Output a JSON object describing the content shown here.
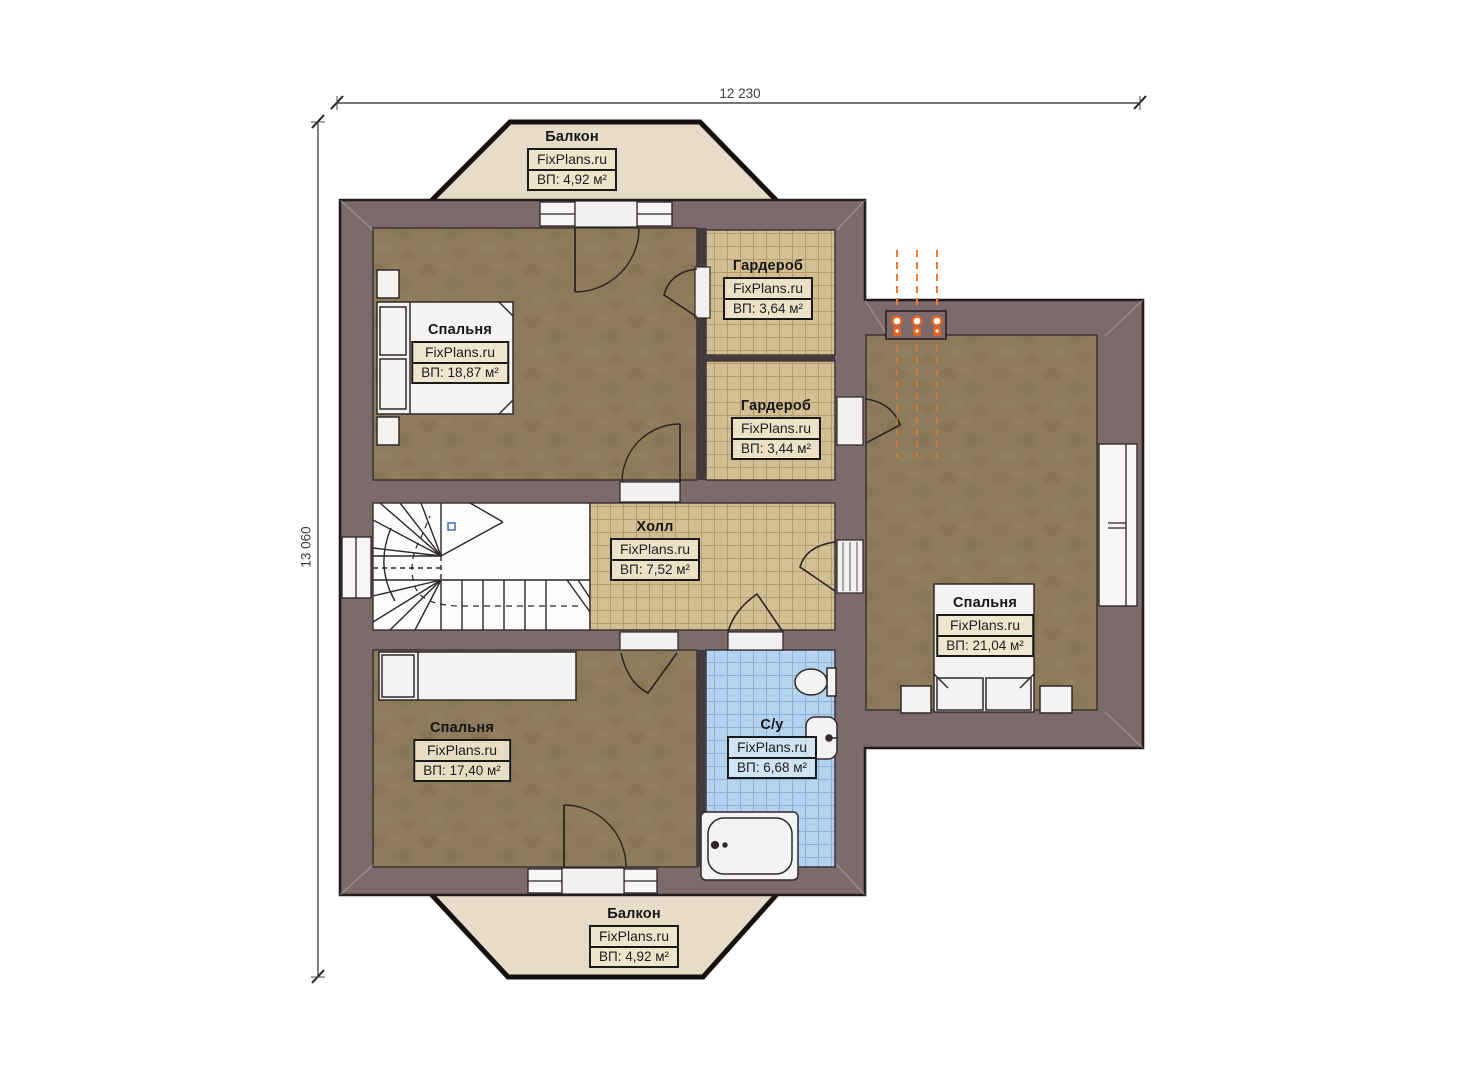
{
  "plan": {
    "type": "floor-plan",
    "floor_note": "second floor plan with stairwell",
    "brand_watermark": "FixPlans.ru"
  },
  "dimensions": {
    "width_label": "12 230",
    "height_label": "13 060"
  },
  "rooms": {
    "balcony_top": {
      "name": "Балкон",
      "brand": "FixPlans.ru",
      "area": "ВП: 4,92 м²"
    },
    "bedroom_top_left": {
      "name": "Спальня",
      "brand": "FixPlans.ru",
      "area": "ВП: 18,87 м²"
    },
    "wardrobe_top": {
      "name": "Гардероб",
      "brand": "FixPlans.ru",
      "area": "ВП: 3,64 м²"
    },
    "wardrobe_mid": {
      "name": "Гардероб",
      "brand": "FixPlans.ru",
      "area": "ВП: 3,44 м²"
    },
    "hall": {
      "name": "Холл",
      "brand": "FixPlans.ru",
      "area": "ВП: 7,52 м²"
    },
    "bedroom_right": {
      "name": "Спальня",
      "brand": "FixPlans.ru",
      "area": "ВП: 21,04 м²"
    },
    "bedroom_bottom_left": {
      "name": "Спальня",
      "brand": "FixPlans.ru",
      "area": "ВП: 17,40 м²"
    },
    "bathroom": {
      "name": "С/у",
      "brand": "FixPlans.ru",
      "area": "ВП: 6,68 м²"
    },
    "balcony_bottom": {
      "name": "Балкон",
      "brand": "FixPlans.ru",
      "area": "ВП: 4,92 м²"
    }
  },
  "colors": {
    "wall": "#7d6a6c",
    "wall-outline": "#241d20",
    "floor-wood": "#8d7b5b",
    "tile-beige": "#d3bf93",
    "tile-line": "#a5905f",
    "tile-blue": "#b5d2ee",
    "tile-blue-line": "#84aace",
    "balcony": "#e6dcc7",
    "stairs": "#fcfcfb",
    "accent-orange": "#e86f24",
    "label-bg": "rgba(238,229,204,0.92)",
    "label-bg-blue": "rgba(212,229,244,0.92)"
  }
}
